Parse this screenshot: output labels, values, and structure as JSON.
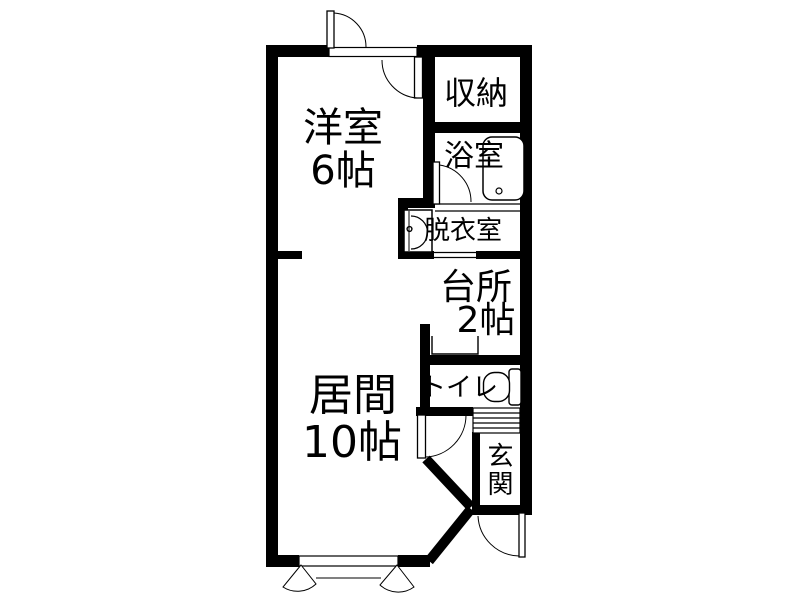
{
  "floorplan": {
    "type": "japanese-apartment-floorplan",
    "rooms": [
      {
        "id": "western-room",
        "label": "洋室",
        "size": "6帖"
      },
      {
        "id": "living-room",
        "label": "居間",
        "size": "10帖"
      },
      {
        "id": "closet",
        "label": "収納"
      },
      {
        "id": "bathroom",
        "label": "浴室"
      },
      {
        "id": "dressing-room",
        "label": "脱衣室"
      },
      {
        "id": "kitchen",
        "label": "台所",
        "size": "2帖"
      },
      {
        "id": "toilet",
        "label": "トイレ"
      },
      {
        "id": "entrance",
        "label": "玄関"
      }
    ],
    "fixtures": [
      "bathtub",
      "washbasin",
      "toilet-bowl",
      "kitchen-sink",
      "entrance-step-hatch",
      "double-casement-window"
    ],
    "doors": [
      "top-outer-door",
      "top-inner-door",
      "bathroom-door",
      "toilet-door",
      "front-door"
    ],
    "colors": {
      "wall": "#000000",
      "background": "#ffffff",
      "text": "#000000"
    }
  }
}
